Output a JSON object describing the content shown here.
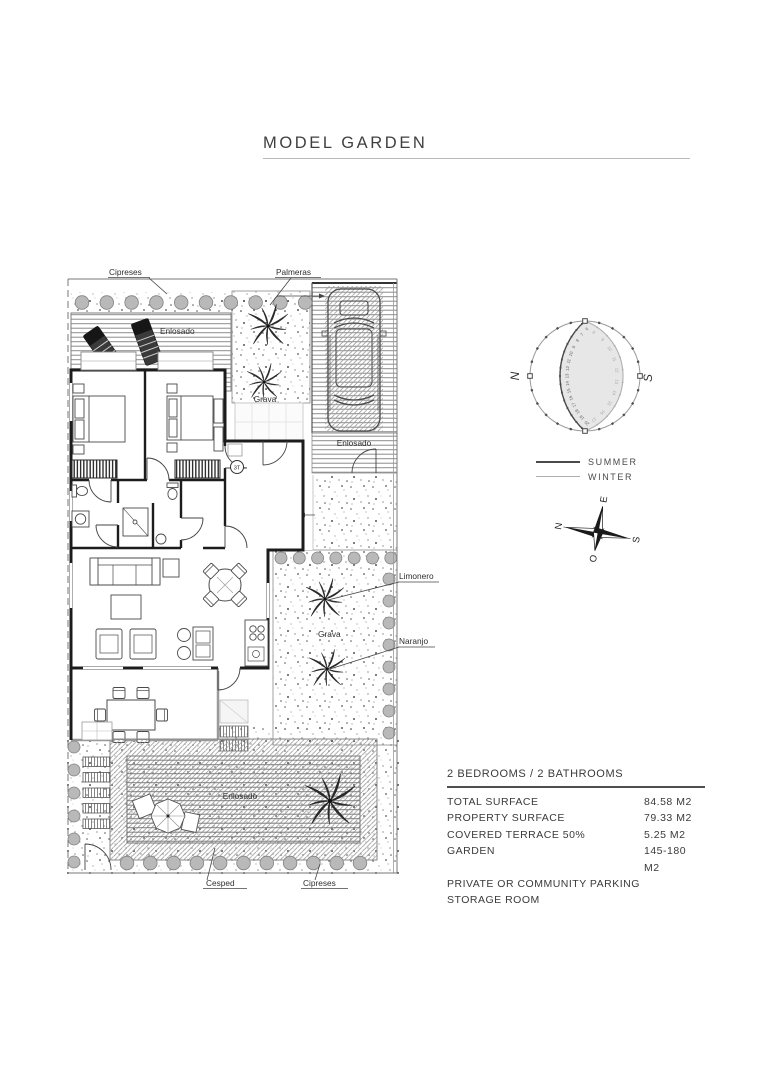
{
  "page": {
    "title": "MODEL GARDEN"
  },
  "plan": {
    "labels": {
      "cipreses_top": "Cipreses",
      "palmeras": "Palmeras",
      "enlosado_top": "Enlosado",
      "grava_top": "Grava",
      "enlosado_drive": "Enlosado",
      "grava_garden": "Grava",
      "limonero": "Limonero",
      "naranjo": "Naranjo",
      "enlosado_bottom": "Enlosado",
      "cesped": "Cesped",
      "cipreses_bottom": "Cipreses",
      "entry_marker": "3T"
    }
  },
  "sun_diagram": {
    "north_label": "N",
    "south_label": "S",
    "summer_hours": [
      "6",
      "7",
      "8",
      "9",
      "10",
      "11",
      "12",
      "13",
      "14",
      "15",
      "16",
      "17",
      "18",
      "19",
      "20"
    ],
    "winter_hours": [
      "8",
      "9",
      "10",
      "11",
      "12",
      "13",
      "14",
      "15",
      "16",
      "17"
    ],
    "legend": [
      {
        "label": "SUMMER",
        "color": "#4a4a4a",
        "thickness": 2
      },
      {
        "label": "WINTER",
        "color": "#b0b0b0",
        "thickness": 1
      }
    ]
  },
  "compass": {
    "n": "N",
    "e": "E",
    "s": "S",
    "o": "O"
  },
  "specs": {
    "header": "2 BEDROOMS / 2 BATHROOMS",
    "rows": [
      {
        "label": "TOTAL SURFACE",
        "value": "84.58 M2"
      },
      {
        "label": "PROPERTY SURFACE",
        "value": "79.33 M2"
      },
      {
        "label": "COVERED TERRACE 50%",
        "value": "5.25 M2"
      },
      {
        "label": "GARDEN",
        "value": "145-180 M2"
      },
      {
        "label": "PRIVATE OR COMMUNITY PARKING",
        "value": ""
      },
      {
        "label": "STORAGE ROOM",
        "value": ""
      }
    ]
  },
  "colors": {
    "accent": "#3f3f3f",
    "shrub": "#b9b9b9",
    "shade": "#e7e7e7"
  }
}
